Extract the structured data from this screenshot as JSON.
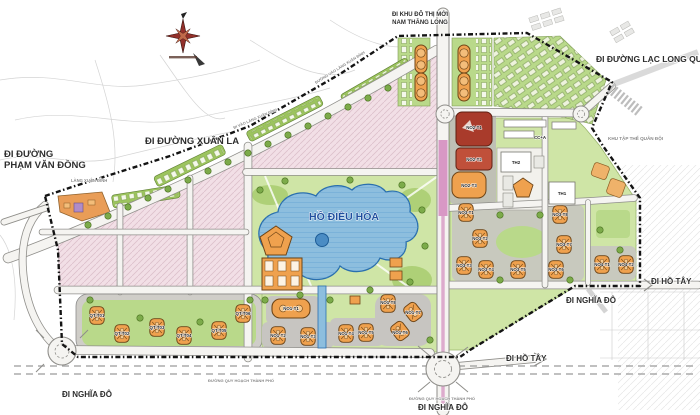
{
  "map": {
    "title_hint": "Urban master plan map",
    "region_labels": {
      "nam_thang_long_1": "ĐI KHU ĐÔ THỊ MỚI",
      "nam_thang_long_2": "NAM THĂNG LONG",
      "lac_long_quan": "ĐI ĐƯỜNG LẠC LONG QUÂN",
      "xuan_la": "ĐI ĐƯỜNG XUÂN LA",
      "pham_van_dong_1": "ĐI ĐƯỜNG",
      "pham_van_dong_2": "PHẠM VĂN ĐỒNG",
      "lang_xuan_dinh": "LÀNG XUÂN ĐỈNH",
      "di_vao_lang": "ĐI VÀO LÀNG XUÂN ĐỈNH",
      "duong_vao_lang": "ĐƯỜNG VÀO LÀNG XUÂN ĐỈNH",
      "ho_dieu_hoa": "HỒ ĐIỀU HÒA",
      "khu_tap_the": "KHU TẬP THỂ QUÂN ĐỘI",
      "ho_tay_right": "ĐI HỒ TÂY",
      "nghia_do_right": "ĐI NGHĨA ĐÔ",
      "ho_tay_bottom": "ĐI HỒ TÂY",
      "nghia_do_bottom": "ĐI NGHĨA ĐÔ",
      "nghia_do_left": "ĐI NGHĨA ĐÔ",
      "duong_quy_hoach_1": "ĐƯỜNG QUY HOẠCH THÀNH PHỐ",
      "duong_quy_hoach_2": "ĐƯỜNG QUY HOẠCH THÀNH PHỐ"
    },
    "plot_labels": {
      "no2": [
        "NO2-T1",
        "NO2-T2",
        "NO2-T3"
      ],
      "cc": "CC+A",
      "schools": [
        "TH2",
        "TH1"
      ],
      "no3": [
        "NO3-T1",
        "NO3-T2",
        "NO3-T3",
        "NO3-T4",
        "NO3-T5",
        "NO3-T6",
        "NO3-T7",
        "NO3-T8"
      ],
      "no4": [
        "NO4-T1",
        "NO4-T2"
      ],
      "no1": [
        "NO1-T1",
        "NO1-T2",
        "NO1-T3",
        "NO1-T4",
        "NO1-T5",
        "NO1-T6",
        "NO1-T7",
        "NO1-T8"
      ],
      "qt": [
        "QT-T01",
        "QT-T02",
        "QT-T03",
        "QT-T04",
        "QT-T05",
        "QT-T06"
      ]
    },
    "colors": {
      "boundary": "#141414",
      "road_fill": "#f5f4f1",
      "road_casing": "#8f8e8a",
      "magenta_road": "#cd7ab5",
      "lake_blue": "#8dbede",
      "lake_outline": "#2a6fae",
      "park_green": "#cfe5a6",
      "block_green": "#b9d98a",
      "pink_residential": "#f2dfe6",
      "tower_orange": "#efa14e",
      "red_block_dark": "#a93b2b",
      "red_block_light": "#c0503a",
      "gray_pad": "#c7c5c1",
      "lake_label_blue": "#1f4f9e"
    }
  }
}
